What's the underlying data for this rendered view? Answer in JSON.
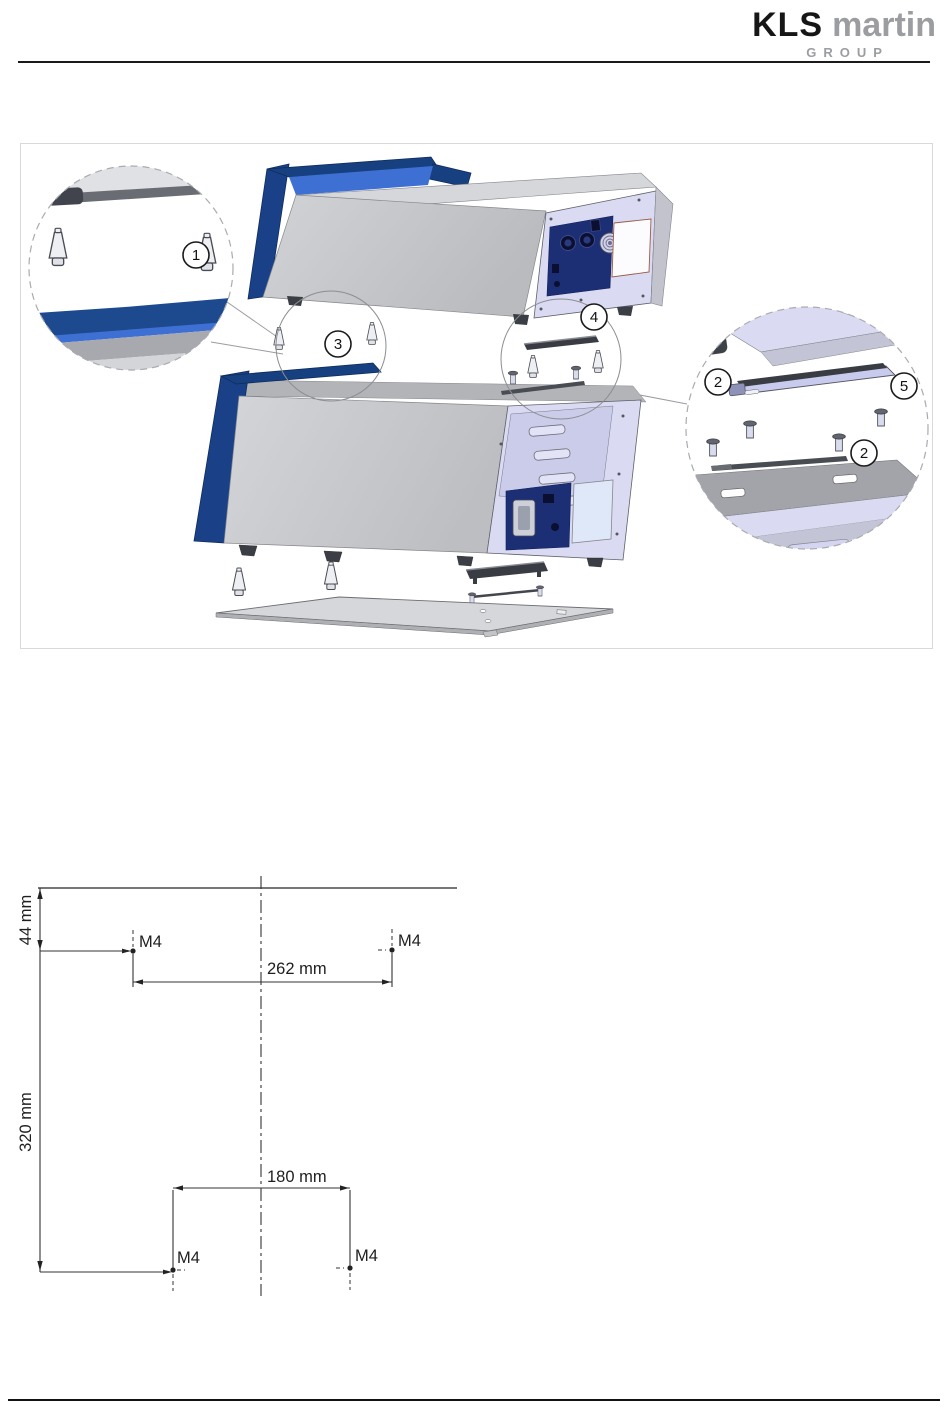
{
  "header": {
    "brand": {
      "kls": "KLS",
      "martin": "martin",
      "group": "GROUP"
    }
  },
  "exploded_view": {
    "description": "exploded view of two stacked devices with stacking feet, mounting brackets, screws and base plate",
    "callouts": {
      "stacking_feet_detail": "1",
      "pins_between_units": "3",
      "bracket_assembly_top": "4",
      "bracket_left": "2",
      "bracket_right": "5",
      "bracket_screws": "2"
    }
  },
  "dimension_drawing": {
    "top_edge_offset": "44 mm",
    "upper_hole_spacing": "262 mm",
    "overall_height": "320 mm",
    "lower_hole_spacing": "180 mm",
    "thread_top_left": "M4",
    "thread_top_right": "M4",
    "thread_bottom_left": "M4",
    "thread_bottom_right": "M4"
  },
  "colors": {
    "device_front_blue": "#1a4187",
    "device_front_blue_bright": "#3e70d4",
    "connector_panel_navy": "#1c2e74",
    "chassis_gray": "#c9cbce",
    "back_panel_lavender": "#dadbf3"
  }
}
